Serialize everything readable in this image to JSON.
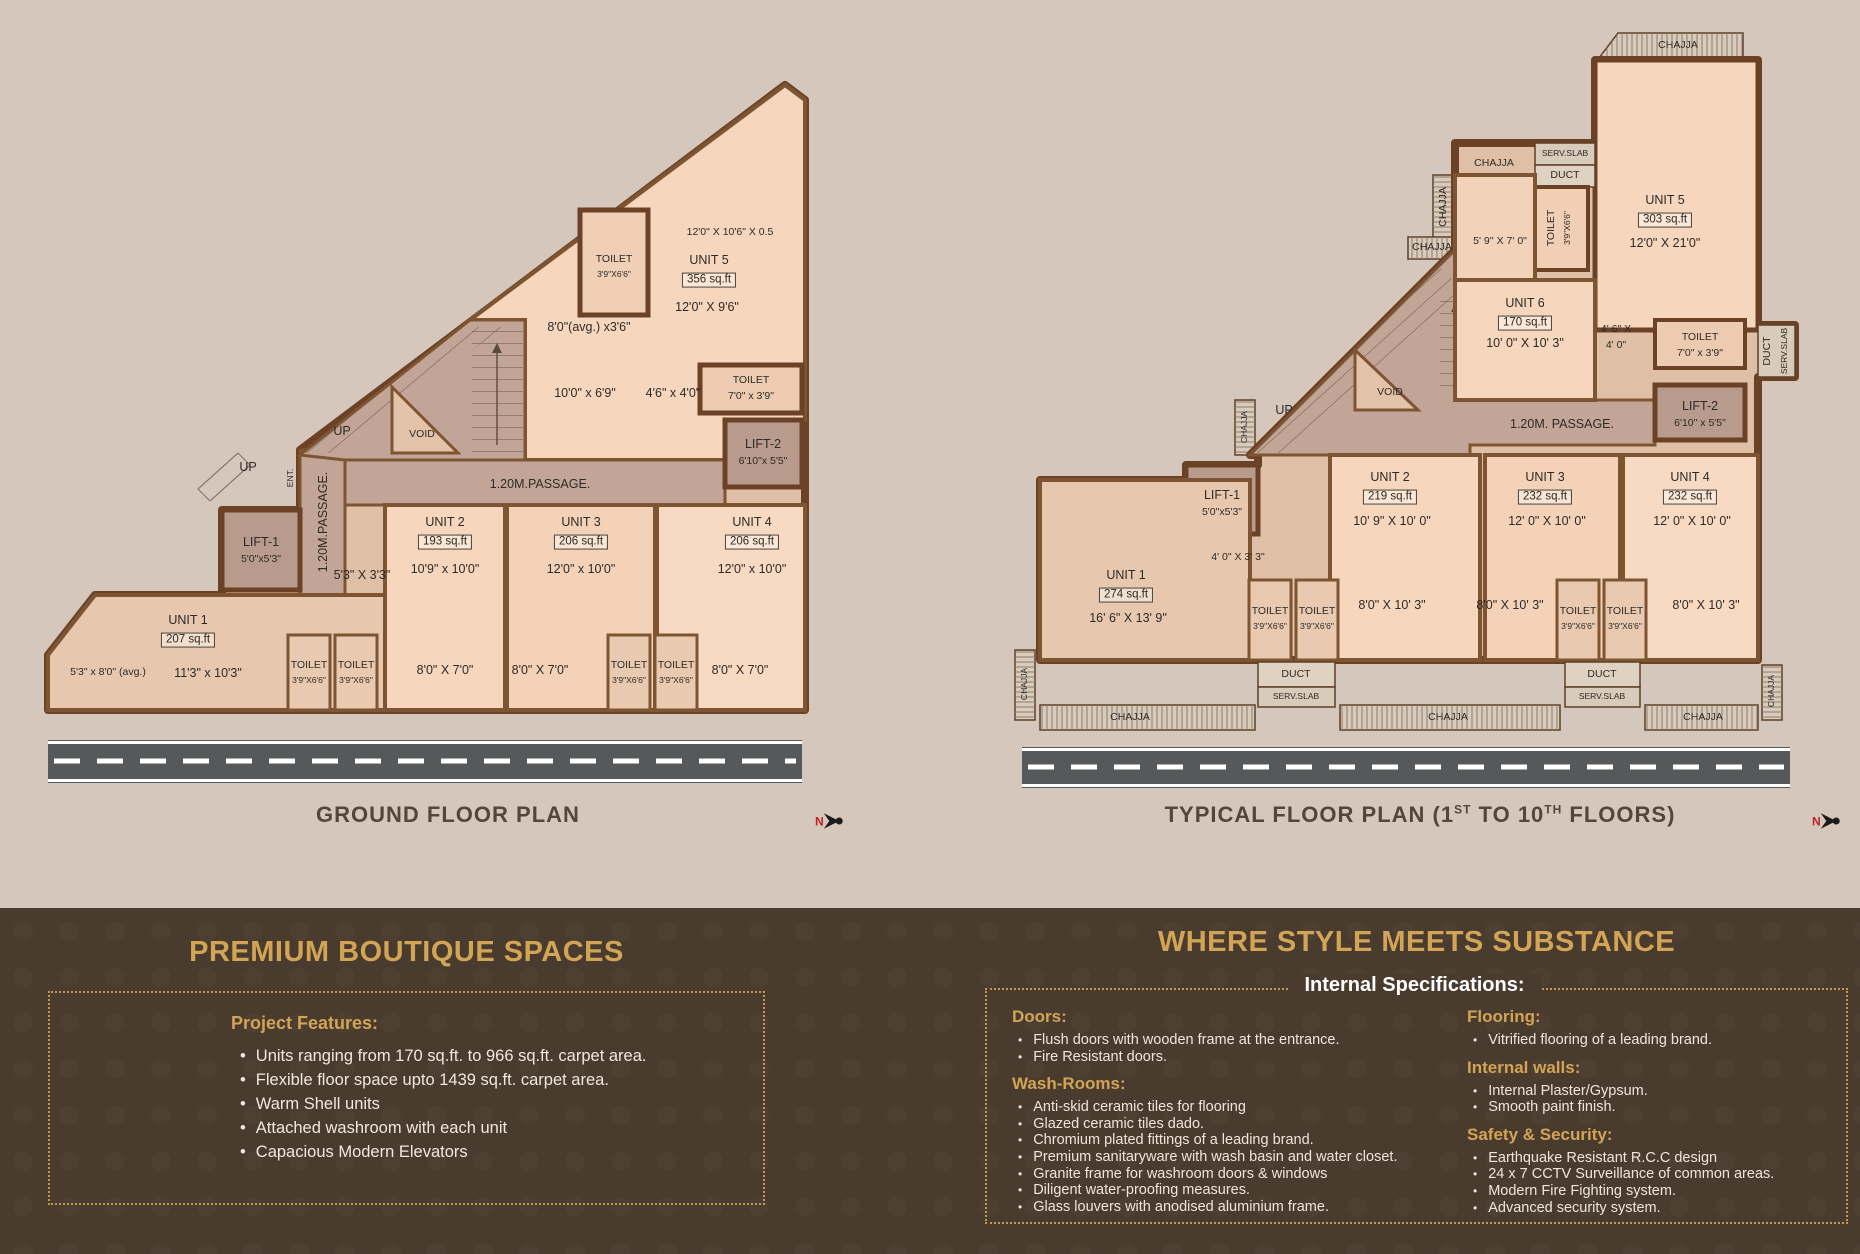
{
  "c": {
    "toilet": "TOILET",
    "tsize": "3'9\"X6'6\"",
    "chajja": "CHAJJA",
    "duct": "DUCT",
    "serv": "SERV.SLAB",
    "up": "UP",
    "void": "VOID",
    "ent": "ENT.",
    "passage": "1.20M.PASSAGE.",
    "north": "N"
  },
  "gp": {
    "title": "GROUND FLOOR PLAN",
    "u1": {
      "n": "UNIT 1",
      "a": "207 sq.ft",
      "d": "11'3\" x 10'3\""
    },
    "u2": {
      "n": "UNIT 2",
      "a": "193 sq.ft",
      "d": "10'9\" x 10'0\""
    },
    "u3": {
      "n": "UNIT 3",
      "a": "206 sq.ft",
      "d": "12'0\" x 10'0\""
    },
    "u4": {
      "n": "UNIT 4",
      "a": "206 sq.ft",
      "d": "12'0\" x 10'0\""
    },
    "u5": {
      "n": "UNIT 5",
      "a": "356 sq.ft",
      "d": "12'0\" X 9'6\""
    },
    "lift1": {
      "n": "LIFT-1",
      "s": "5'0\"x5'3\""
    },
    "lift2": {
      "n": "LIFT-2",
      "s": "6'10\"x 5'5\""
    },
    "toilet_r": "7'0\" x 3'9\"",
    "dim_top": "12'0\" X 10'6\" X 0.5",
    "dim_avg8": "8'0\"(avg.) x3'6\"",
    "dim_1069": "10'0\" x 6'9\"",
    "dim_4640": "4'6\" x 4'0\"",
    "dim_5333": "5'3\" X 3'3\"",
    "dim_5380": "5'3\" x 8'0\" (avg.)",
    "dim_8070": "8'0\" X 7'0\""
  },
  "tp": {
    "t1": "TYPICAL FLOOR PLAN (1",
    "s1": "ST",
    "t2": " TO 10",
    "s2": "TH",
    "t3": " FLOORS)",
    "u1": {
      "n": "UNIT 1",
      "a": "274 sq.ft",
      "d": "16' 6\" X 13' 9\""
    },
    "u2": {
      "n": "UNIT 2",
      "a": "219 sq.ft",
      "d": "10' 9\" X 10' 0\""
    },
    "u3": {
      "n": "UNIT 3",
      "a": "232 sq.ft",
      "d": "12' 0\" X 10' 0\""
    },
    "u4": {
      "n": "UNIT 4",
      "a": "232 sq.ft",
      "d": "12' 0\" X 10' 0\""
    },
    "u5": {
      "n": "UNIT 5",
      "a": "303 sq.ft",
      "d": "12'0\" X 21'0\""
    },
    "u6": {
      "n": "UNIT 6",
      "a": "170 sq.ft",
      "d": "10' 0\" X 10' 3\""
    },
    "lift1": {
      "n": "LIFT-1",
      "s": "5'0\"x5'3\""
    },
    "lift2": {
      "n": "LIFT-2",
      "s": "6'10\" x 5'5\""
    },
    "toilet_m": "7'0\" x 3'9\"",
    "dim_5970": "5' 9'' X 7' 0\"",
    "dim_46a": "4' 6\" X",
    "dim_46b": "4' 0\"",
    "dim_4033": "4' 0\" X 3' 3\"",
    "dim_80103": "8'0\" X 10' 3\"",
    "passage": "1.20M. PASSAGE."
  },
  "features": {
    "title": "PREMIUM BOUTIQUE SPACES",
    "heading": "Project Features:",
    "items": [
      "Units ranging from 170 sq.ft. to 966 sq.ft. carpet area.",
      "Flexible floor space upto 1439 sq.ft. carpet area.",
      "Warm Shell units",
      "Attached washroom with each unit",
      "Capacious Modern Elevators"
    ]
  },
  "specs": {
    "title": "WHERE STYLE MEETS SUBSTANCE",
    "heading": "Internal Specifications:",
    "groups": [
      {
        "h": "Doors:",
        "items": [
          "Flush doors with wooden frame at the entrance.",
          "Fire Resistant doors."
        ]
      },
      {
        "h": "Wash-Rooms:",
        "items": [
          "Anti-skid ceramic tiles for flooring",
          "Glazed ceramic tiles dado.",
          "Chromium plated fittings of a leading brand.",
          "Premium sanitaryware with wash basin and water closet.",
          "Granite frame for washroom doors & windows",
          "Diligent water-proofing measures.",
          "Glass louvers with anodised aluminium frame."
        ]
      },
      {
        "h": "Flooring:",
        "items": [
          "Vitrified flooring of a leading brand."
        ]
      },
      {
        "h": "Internal walls:",
        "items": [
          "Internal Plaster/Gypsum.",
          "Smooth paint finish."
        ]
      },
      {
        "h": "Safety & Security:",
        "items": [
          "Earthquake Resistant R.C.C design",
          "24 x 7 CCTV Surveillance of common areas.",
          "Modern Fire Fighting system.",
          "Advanced security system."
        ]
      }
    ]
  },
  "colors": {
    "gold": "#d2a455",
    "bg_top": "#d6c7bc",
    "bg_bottom": "#4a3b2f",
    "road": "#57585a",
    "accent_red": "#c22026"
  }
}
